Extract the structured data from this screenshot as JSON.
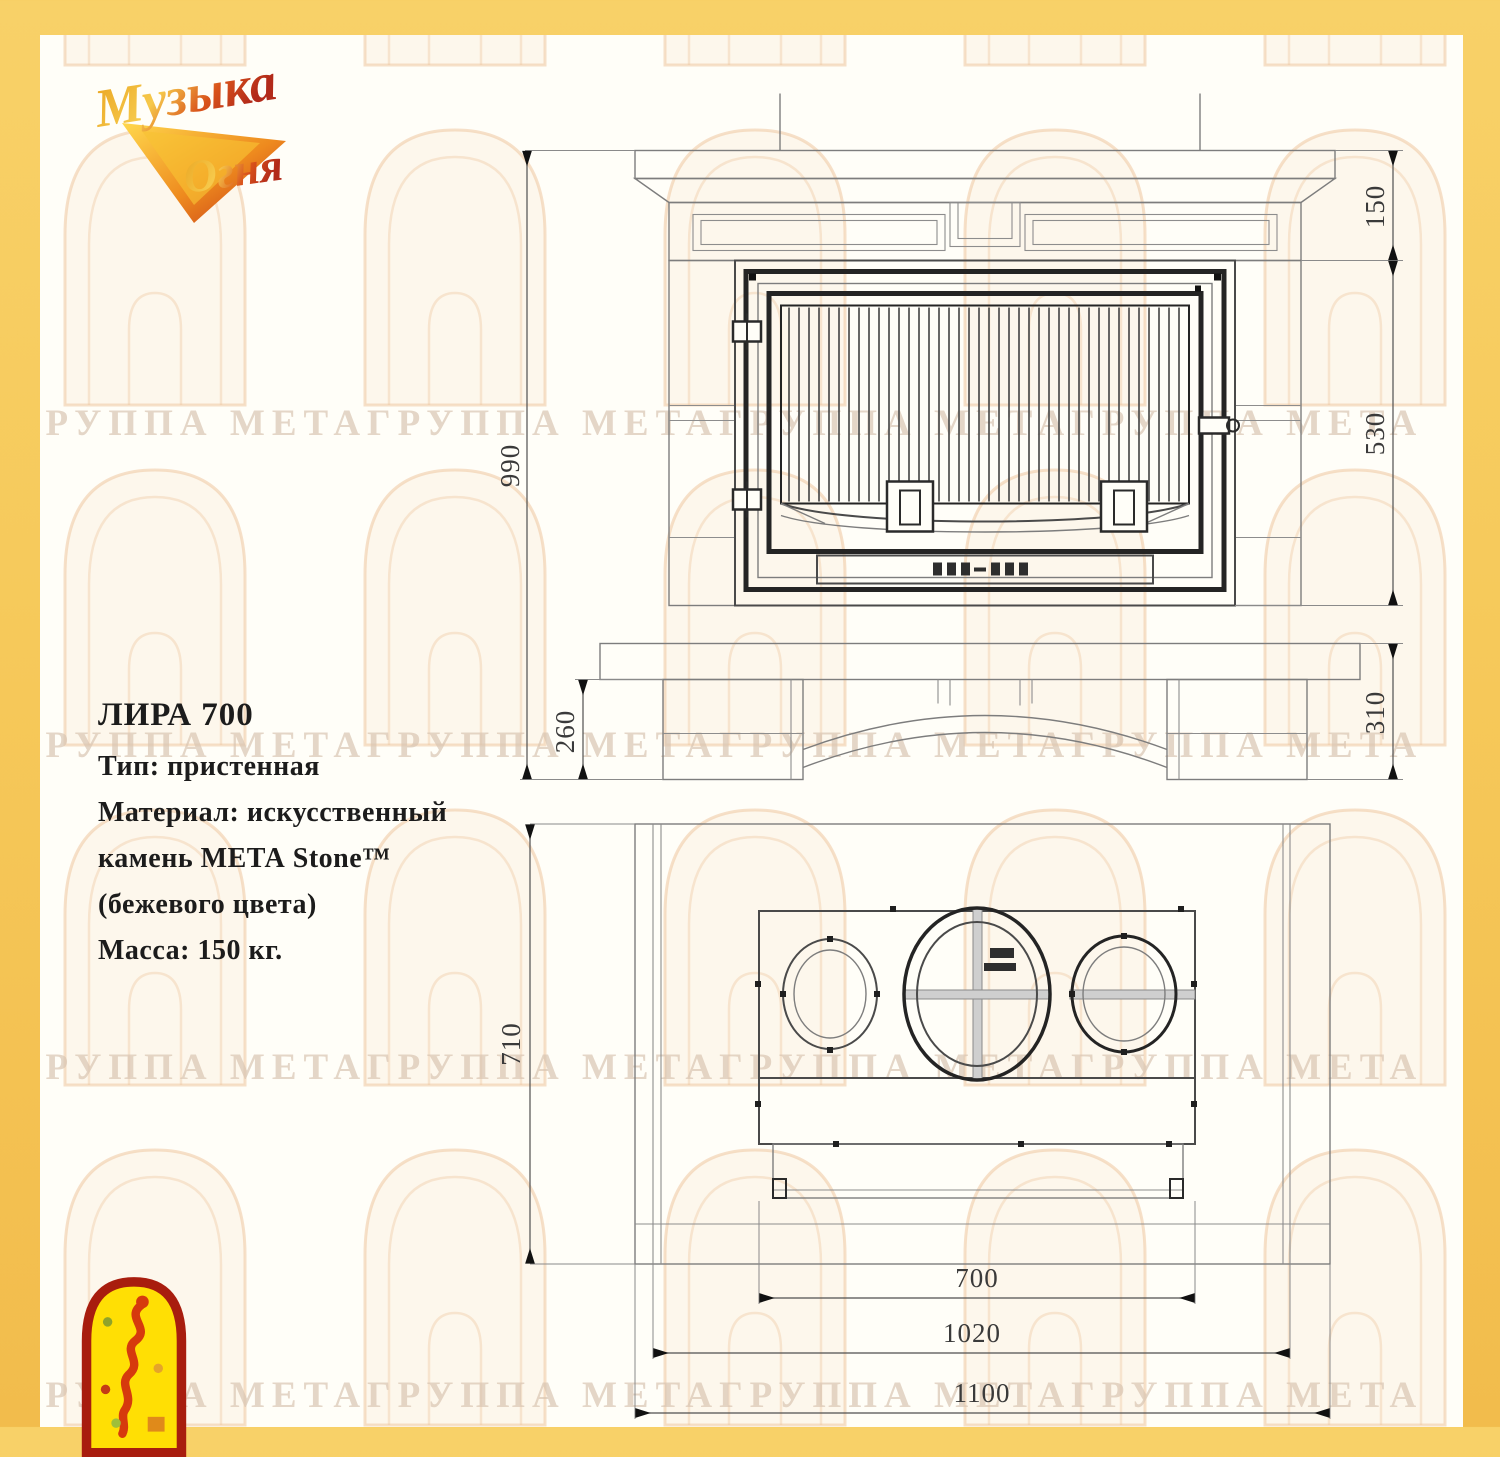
{
  "brand": {
    "logo_word1": "Музыка",
    "logo_word2": "Огня"
  },
  "product": {
    "title": "ЛИРА 700",
    "spec_lines": [
      "Тип: пристенная",
      "Материал: искусственный",
      "камень МЕТА Stone™",
      "(бежевого цвета)",
      "Масса: 150 кг."
    ]
  },
  "watermark": {
    "row_text": "ГРУППА МЕТАГРУППА МЕТАГРУППА МЕТАГРУППА МЕТА"
  },
  "front_view": {
    "dims": {
      "overall_height": "990",
      "base_left": "260",
      "top_section": "150",
      "firebox": "530",
      "base_right": "310"
    }
  },
  "plan_view": {
    "dims": {
      "depth": "710",
      "firebox_width": "700",
      "body_width": "1020",
      "overall_width": "1100"
    }
  },
  "colors": {
    "border": "#F6C95A",
    "paper": "#FFFEF8"
  }
}
